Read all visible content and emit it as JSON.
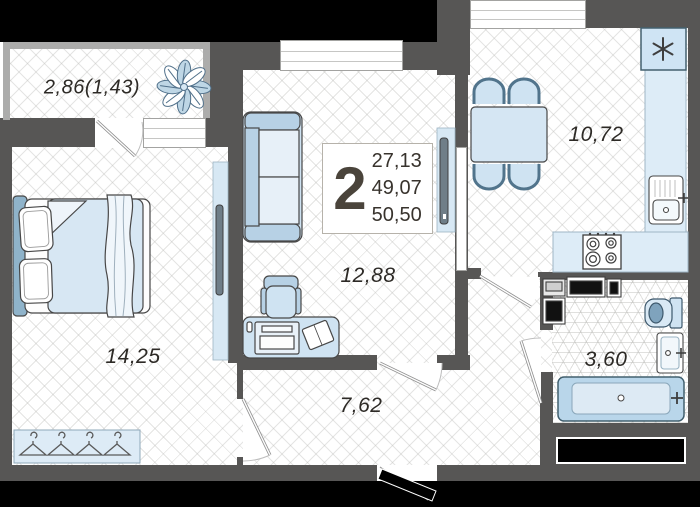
{
  "plan": {
    "summary": {
      "rooms_count": "2",
      "living_area": "27,13",
      "apartment_area": "49,07",
      "total_area": "50,50"
    },
    "rooms": {
      "balcony": "2,86(1,43)",
      "bedroom": "14,25",
      "living_room": "12,88",
      "kitchen": "10,72",
      "hallway": "7,62",
      "bathroom": "3,60"
    },
    "colors": {
      "wall": "#575655",
      "outside": "#000000",
      "furniture_fill": "#cfe3f2",
      "furniture_accent": "#b7d1e5",
      "fixture_dark": "#7fa3bd",
      "text": "#38332d",
      "floor_line": "#dcdcda"
    }
  }
}
